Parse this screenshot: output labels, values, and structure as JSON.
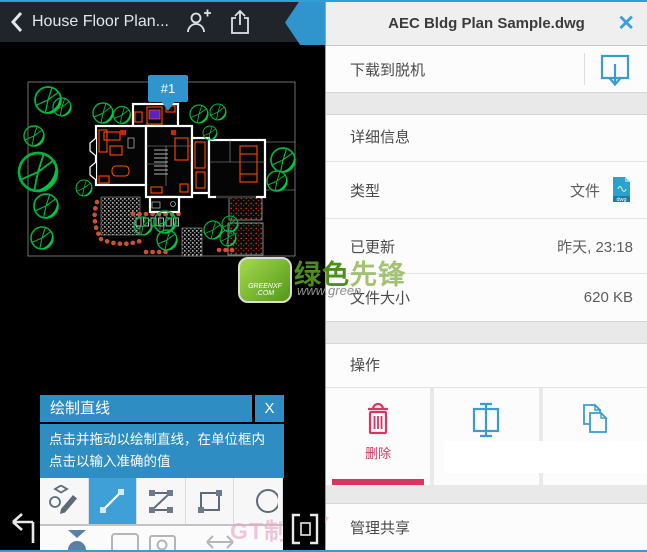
{
  "colors": {
    "accent_blue": "#2f9fd6",
    "tooltip_blue": "#2e8dc3",
    "selected_tool_blue": "#3fa0d8",
    "delete_red": "#d6365f",
    "dwg_icon_teal": "#29a3c9",
    "tree_green": "#00b33c"
  },
  "left_pane": {
    "topbar": {
      "title": "House Floor Plan..."
    },
    "drawing": {
      "marker_label": "#1"
    },
    "tooltip": {
      "title": "绘制直线",
      "close": "X",
      "body": "点击并拖动以绘制直线，在单位框内点击以输入准确的值"
    },
    "toolbar": {
      "tools": [
        "sketch",
        "line",
        "polyline",
        "rectangle",
        "circle"
      ],
      "selected_tool": "line"
    }
  },
  "right_panel": {
    "header": {
      "title": "AEC Bldg Plan Sample.dwg",
      "close": "✕"
    },
    "download": {
      "label": "下载到脱机"
    },
    "details": {
      "title": "详细信息",
      "rows": [
        {
          "label": "类型",
          "value": "文件"
        },
        {
          "label": "已更新",
          "value": "昨天, 23:18"
        },
        {
          "label": "文件大小",
          "value": "620 KB"
        }
      ]
    },
    "actions": {
      "title": "操作",
      "items": [
        {
          "label": "删除",
          "icon": "trash",
          "selected": true
        },
        {
          "label": "",
          "icon": "rename"
        },
        {
          "label": "",
          "icon": "copy"
        }
      ]
    },
    "share": {
      "title": "管理共享"
    }
  },
  "watermark": {
    "brand_part1": "绿色",
    "brand_part2": "先锋",
    "url": "www.green",
    "logo_line1": "GREENXF",
    "logo_line2": ".COM",
    "corner_left": "GT制W",
    "corner_right": "Y"
  }
}
